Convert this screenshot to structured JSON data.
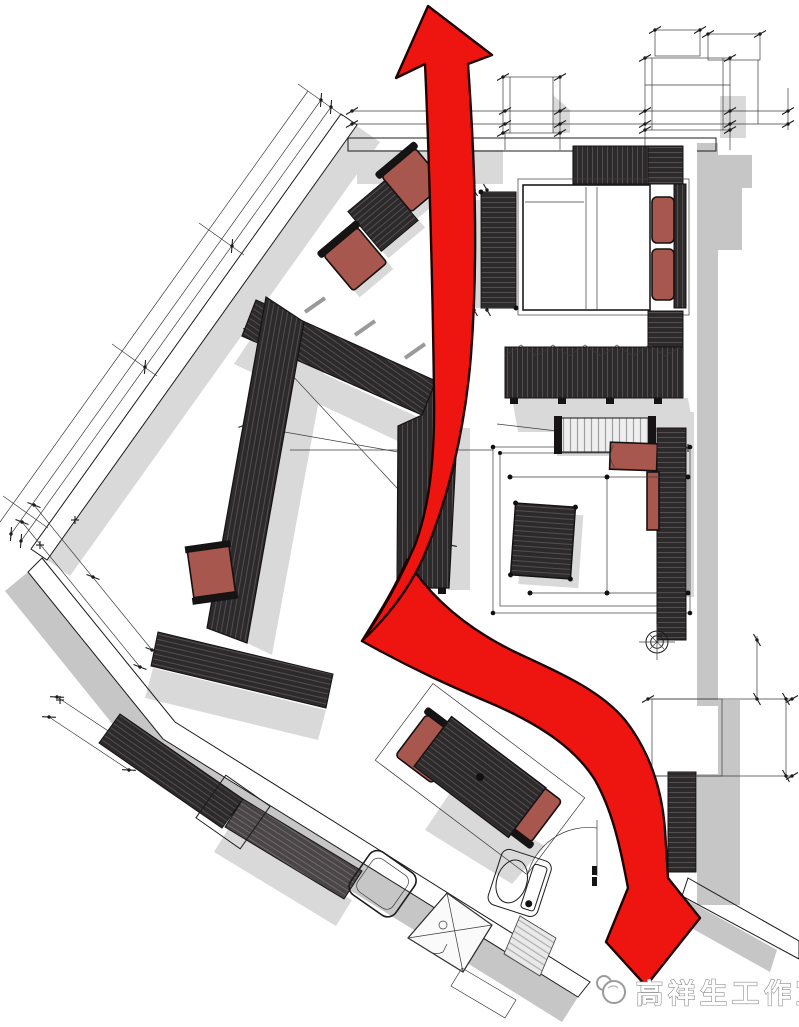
{
  "canvas": {
    "width": 799,
    "height": 1027,
    "background": "#ffffff"
  },
  "watermark": {
    "logo": "studio-logo-circles",
    "text": "高祥生工作室"
  },
  "colors": {
    "arrow": "#ee1510",
    "furniture": "#2d2a2b",
    "upholstery": "#a8574f",
    "wall": "#c6c6c6",
    "shadow": "#d9d9d9",
    "line": "#1c1c1c",
    "paper": "#ffffff"
  },
  "plan": {
    "type": "interior-furniture-floor-plan",
    "style": "sketch-style rendered plan with drop shadows and dimension lines",
    "flow_arrow": {
      "shape": "s-curve ribbon with fold",
      "from": "entry door at bottom right",
      "to": "terrace at top",
      "heads": [
        "pointing up at top",
        "pointing down-left at bottom"
      ],
      "color": "#ee1510"
    },
    "rooms": [
      "bedroom",
      "dressing-area",
      "lounge-seating-area",
      "vanity-desk-area",
      "kitchen",
      "dining-area",
      "bathroom",
      "entry",
      "terrace-balcony"
    ],
    "furniture": [
      "double-bed",
      "bed-pillows",
      "headboard",
      "nightstands",
      "bed-end-bench",
      "sliding-wardrobe",
      "l-shaped-closet",
      "sofa-outline",
      "window-bench",
      "seat-cushions",
      "coffee-table",
      "console-shelf",
      "armchair",
      "armchair",
      "side-table",
      "vanity-counter",
      "vanity-stool",
      "kitchen-counter",
      "kitchen-sink",
      "kitchen-appliance",
      "dining-table",
      "dining-chair",
      "dining-chair",
      "shower-enclosure",
      "toilet",
      "bath-shelf"
    ],
    "symbols": [
      "dimension-lines",
      "tick-marks",
      "door-swing-arc",
      "floor-drain-symbol",
      "balcony-outlines"
    ]
  }
}
